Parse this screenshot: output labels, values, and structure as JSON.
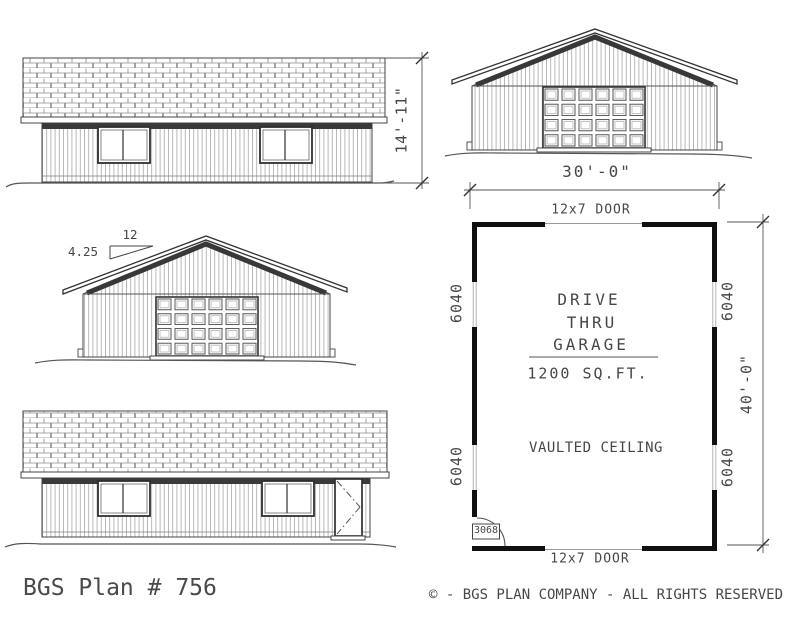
{
  "title_block": {
    "plan_label": "BGS Plan # 756",
    "copyright": "© - BGS PLAN COMPANY - ALL RIGHTS RESERVED"
  },
  "rear_elevation": {
    "height_dim": "14'-11\""
  },
  "left_elevation": {
    "pitch_rise": "4.25",
    "pitch_run": "12"
  },
  "front_elevation": {
    "width_dim": "30'-0\""
  },
  "floor_plan": {
    "top_door_label": "12x7 DOOR",
    "bottom_door_label": "12x7 DOOR",
    "room_name": {
      "line1": "DRIVE",
      "line2": "THRU",
      "line3": "GARAGE"
    },
    "area": "1200 SQ.FT.",
    "ceiling": "VAULTED CEILING",
    "depth_dim": "40'-0\"",
    "windows": {
      "left_top": "6040",
      "left_bottom": "6040",
      "right_top": "6040",
      "right_bottom": "6040"
    },
    "entry_door": "3068"
  }
}
